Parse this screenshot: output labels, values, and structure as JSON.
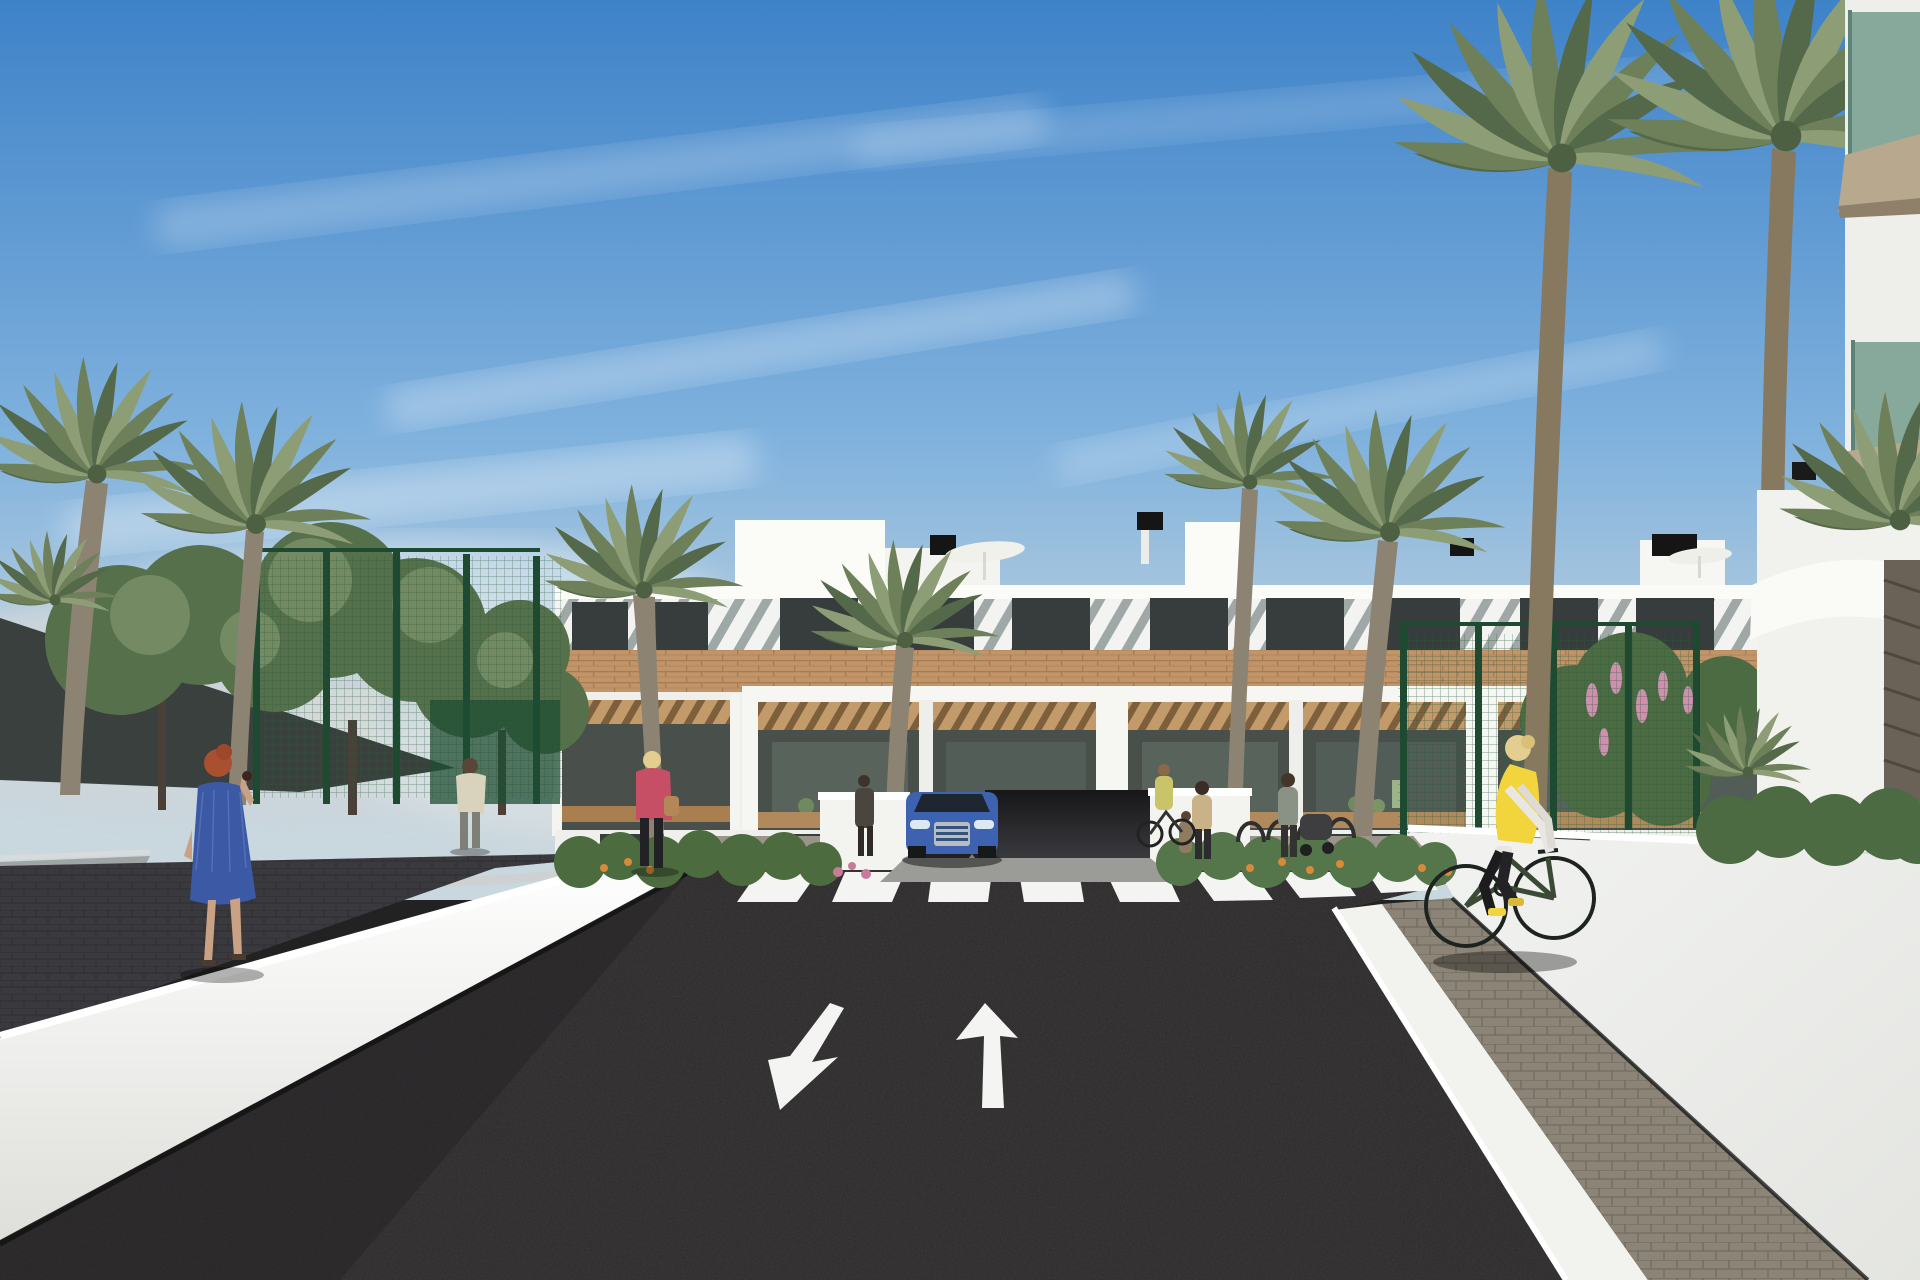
{
  "meta": {
    "title": "Exterior 3D visualization of a modern Mediterranean apartment complex with palm-lined street",
    "type": "architectural-render",
    "no_text_in_image": true
  },
  "scene": {
    "sky": {
      "condition": "clear with wispy clouds",
      "cloud_band": "soft gray-white clouds near horizon"
    },
    "building": {
      "stories": 3,
      "style": "white modern with wooden accent bands, slatted pergola shadows, recessed balconies",
      "rooftop": [
        "chimney-boxes",
        "white-parasols",
        "stair-towers"
      ]
    },
    "road": {
      "surface": "dark asphalt",
      "crosswalk_stripes": 8,
      "lane_arrows": [
        {
          "direction": "down-left",
          "lane": "left"
        },
        {
          "direction": "straight-up",
          "lane": "right"
        }
      ],
      "small_markings": [
        "mini-arrow-down",
        "mini-arrow-up"
      ]
    },
    "vehicles": [
      {
        "type": "suv",
        "color_name": "blue",
        "position": "at garage entrance"
      }
    ],
    "people": [
      {
        "id": "woman-blue-dress",
        "detail": "red hair, blue patterned dress, phone to ear, left sidewalk"
      },
      {
        "id": "woman-pink-jacket",
        "detail": "blonde, pink jacket, black pants, tan handbag"
      },
      {
        "id": "man-beige-shirt",
        "detail": "walking away on left path"
      },
      {
        "id": "person-dark-standing",
        "detail": "standing left of garage drive"
      },
      {
        "id": "mother-and-child",
        "detail": "right of crosswalk"
      },
      {
        "id": "person-with-stroller",
        "detail": "right sidewalk area"
      },
      {
        "id": "small-cyclist-near-racks",
        "detail": "by bicycle racks"
      },
      {
        "id": "cyclist-yellow-vest",
        "detail": "blonde woman, yellow vest, white sleeves, black leggings, green bicycle, right sidewalk"
      },
      {
        "id": "balcony-figures",
        "detail": "tiny residents on terraces"
      }
    ],
    "vegetation": [
      "date-palms",
      "fan-palms",
      "leafy-trees",
      "hedges",
      "orange-flowers",
      "pink-flower-spikes"
    ],
    "structures": [
      "green-mesh-fence",
      "dark-shade-sail",
      "white-ramp-walls",
      "bike-racks",
      "glass-balcony-building-right"
    ]
  },
  "palette": {
    "sky_top": "#3e82c8",
    "sky_mid": "#82b3de",
    "sky_low": "#c9d7de",
    "cloud": "#eef3f5",
    "cloud_gray": "#c6d0d6",
    "building_white": "#f4f4f1",
    "parapet": "#fafaf7",
    "slat_shadow": "#9aa4a2",
    "window_dark": "#373d3c",
    "wood": "#c1946a",
    "wood_dark": "#a67c50",
    "balcony_interior": "#49504c",
    "glass_green": "#7ba193",
    "slab_tan": "#b7a88e",
    "foliage": "#55704a",
    "foliage_light": "#7b9168",
    "palm_green": "#6d8059",
    "palm_light": "#8d9e76",
    "palm_dark": "#54684a",
    "trunk": "#8d8372",
    "shade_sail": "#3a403d",
    "fence_green": "#1f4e33",
    "asphalt": "#2d2b2c",
    "path_dark": "#434347",
    "wall_white": "#f6f6f3",
    "wall_shade": "#a3a8a9",
    "curb_white": "#f2f2ef",
    "paver": "#8b8477",
    "marking_white": "#f4f4f2",
    "car_blue": "#3d63b0",
    "vest_yellow": "#f2d43c",
    "dress_blue": "#3c59a6",
    "jacket_pink": "#c64f66",
    "skin": "#c9a184",
    "hair_red": "#a8502f",
    "hair_blonde": "#e3cd8f",
    "flower_orange": "#d88a3a",
    "flower_pink": "#cf8fae",
    "stone_dark": "#6b6257"
  }
}
